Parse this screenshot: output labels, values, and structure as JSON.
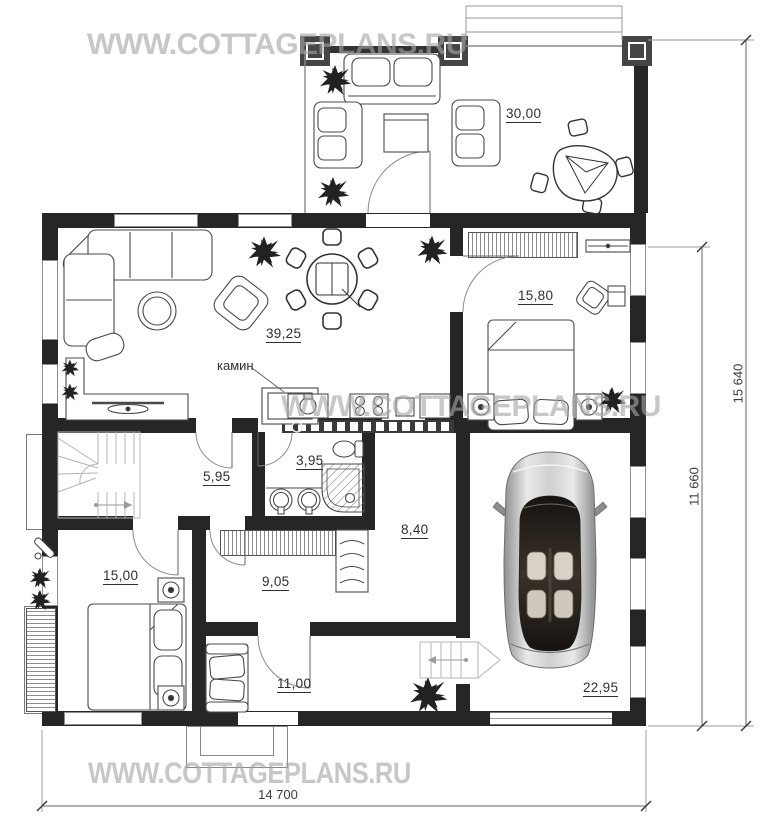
{
  "watermark": {
    "text": "WWW.COTTAGEPLANS.RU"
  },
  "rooms": {
    "terrace": "30,00",
    "living": "39,25",
    "bedroom_top": "15,80",
    "stair_hall": "5,95",
    "bathroom": "3,95",
    "corridor": "8,40",
    "dressing": "9,05",
    "bedroom_bottom": "15,00",
    "entrance_hall": "11,00",
    "garage": "22,95"
  },
  "annotations": {
    "fireplace": "камин"
  },
  "dimensions": {
    "height_total": "15 640",
    "height_main": "11 660",
    "width_total": "14 700"
  },
  "colors": {
    "wall": "#262626",
    "furniture_line": "#4a4a4a",
    "stair_line": "#b4b4b4",
    "watermark": "#c8c8c8",
    "dimension_line": "#666666"
  }
}
